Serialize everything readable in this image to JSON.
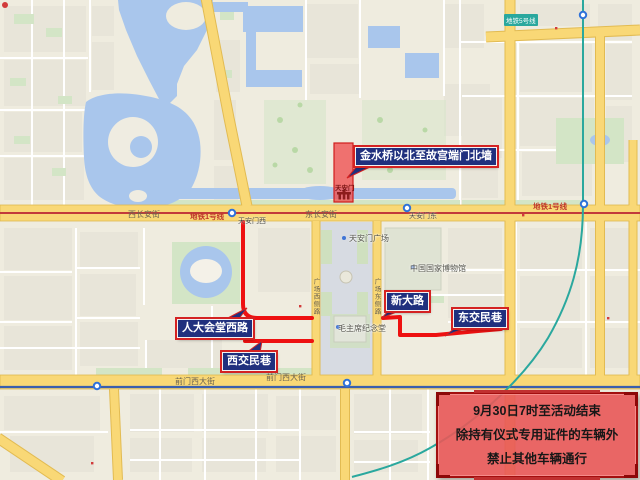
{
  "map": {
    "callouts": {
      "restricted_zone": "金水桥以北至故宫端门北墙",
      "renda_huitang_west_rd": "人大会堂西路",
      "west_jiaomin_lane": "西交民巷",
      "xin_da_lu": "新大路",
      "east_jiaomin_lane": "东交民巷"
    },
    "notice_box": {
      "line1": "9月30日7时至活动结束",
      "line2": "除持有仪式专用证件的车辆外",
      "line3": "禁止其他车辆通行"
    },
    "pois": {
      "tiananmen": "天安门",
      "tiananmen_square": "天安门广场",
      "chairman_mao_memorial_hall": "毛主席纪念堂",
      "national_museum": "中国国家博物馆"
    },
    "road_labels": {
      "west_changan_st": "西长安街",
      "east_changan_st": "东长安街",
      "metro_line_1": "地铁1号线",
      "qianmen_west_st": "前门西大街",
      "square_west_side_rd": "广场西侧路",
      "square_east_side_rd": "广场东侧路"
    },
    "station_labels": {
      "tiananmen_west": "天安门西",
      "tiananmen_east": "天安门东"
    },
    "badges": {
      "metro_line_5": "地铁5号线"
    },
    "colors": {
      "route_red": "#ee1111",
      "zone_fill": "#ef5353",
      "callout_bg": "#20307e",
      "callout_border": "#d42222",
      "notice_bg": "#e95858",
      "notice_border": "#a30f0f",
      "water": "#a9c6ec",
      "road_yellow": "#f9d876",
      "metro1": "#c23b3b",
      "metro2": "#3a5fae",
      "metro5": "#2aa89e",
      "square_grey": "#d7dbe2",
      "park_green": "#d3e5c6"
    }
  }
}
